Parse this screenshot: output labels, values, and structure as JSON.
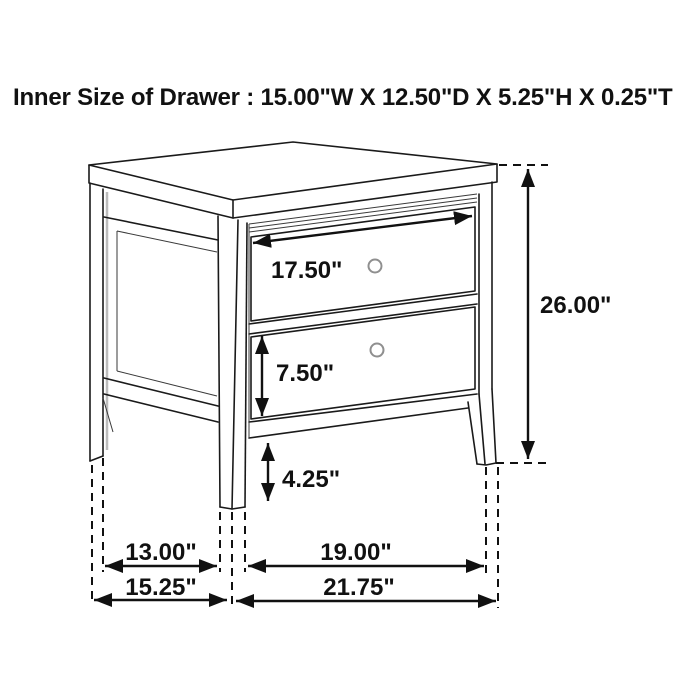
{
  "title": "Inner Size of Drawer : 15.00\"W X 12.50\"D X 5.25\"H X 0.25\"T",
  "product": "two-drawer nightstand dimension diagram",
  "inner_drawer_size": {
    "width": "15.00\"",
    "depth": "12.50\"",
    "height": "5.25\"",
    "thickness": "0.25\""
  },
  "dims": {
    "drawer_face_width": "17.50\"",
    "overall_height": "26.00\"",
    "bottom_drawer_height": "7.50\"",
    "leg_height": "4.25\"",
    "side_inner_span": "13.00\"",
    "side_overall_depth": "15.25\"",
    "front_inner_span": "19.00\"",
    "front_overall_width": "21.75\""
  },
  "colors": {
    "line": "#1a1a1a",
    "dimension": "#111111",
    "background": "#ffffff",
    "knob": "#8f8f8f"
  }
}
